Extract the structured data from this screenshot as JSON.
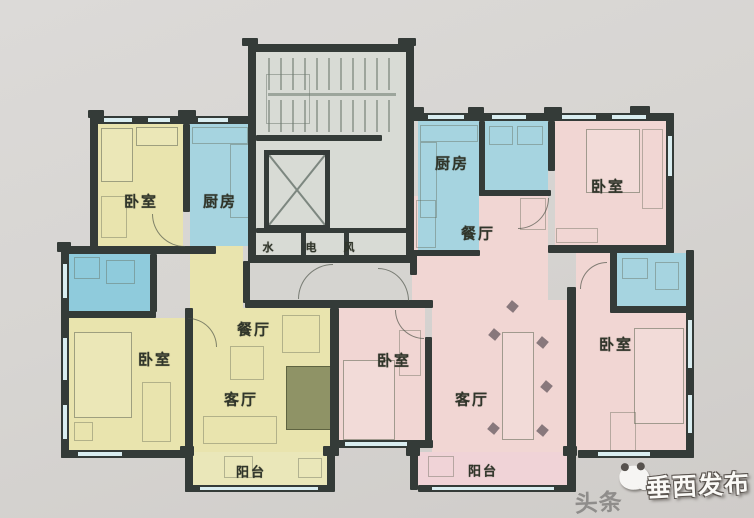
{
  "document": {
    "type": "residential-floor-plan",
    "units": 2,
    "description_note": ""
  },
  "labels": {
    "left_bedroom_top": "卧室",
    "left_kitchen": "厨房",
    "left_bedroom_main": "卧室",
    "left_dining": "餐厅",
    "left_living": "客厅",
    "left_balcony": "阳台",
    "right_kitchen": "厨房",
    "right_bedroom_top": "卧室",
    "right_dining": "餐厅",
    "right_bedroom_mid": "卧室",
    "right_living": "客厅",
    "right_bedroom_right": "卧室",
    "right_balcony": "阳台",
    "shaft_water": "水",
    "shaft_electric": "电",
    "shaft_vent": "风"
  },
  "watermark": {
    "platform_text": "头条",
    "account_text": "垂西发布"
  },
  "colors": {
    "wall": "#343b38",
    "room_yellow": "#e9e4ae",
    "room_blue": "#a6d4e0",
    "room_pink": "#f1d6d3",
    "core_fill": "#d8dbd5",
    "background": "#d7d5d2",
    "label_text": "#30352a"
  }
}
